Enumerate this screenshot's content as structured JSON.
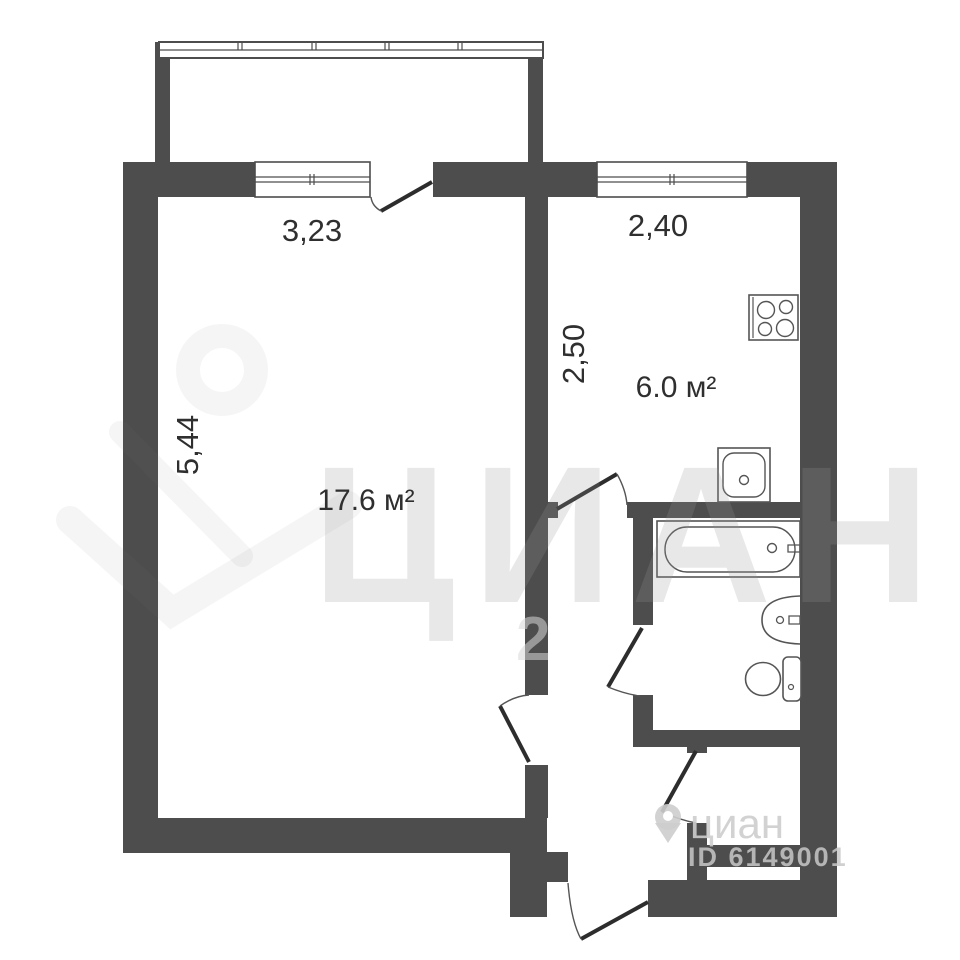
{
  "rooms": {
    "living": {
      "area": "17.6 м²",
      "width_dim": "3,23",
      "height_dim": "5,44"
    },
    "kitchen": {
      "area": "6.0 м²",
      "width_dim": "2,40",
      "height_dim": "2,50"
    }
  },
  "watermark": {
    "brand_large": "ЦИАН",
    "brand_small": "циан",
    "listing_id": "ID 6149001",
    "stray_digit": "2"
  },
  "colors": {
    "wall": "#4d4d4d",
    "door_leaf": "#2d2d2d",
    "fixture_line": "#555555",
    "label_text": "#2f2f2f",
    "watermark_grey": "#c9c9c9"
  }
}
